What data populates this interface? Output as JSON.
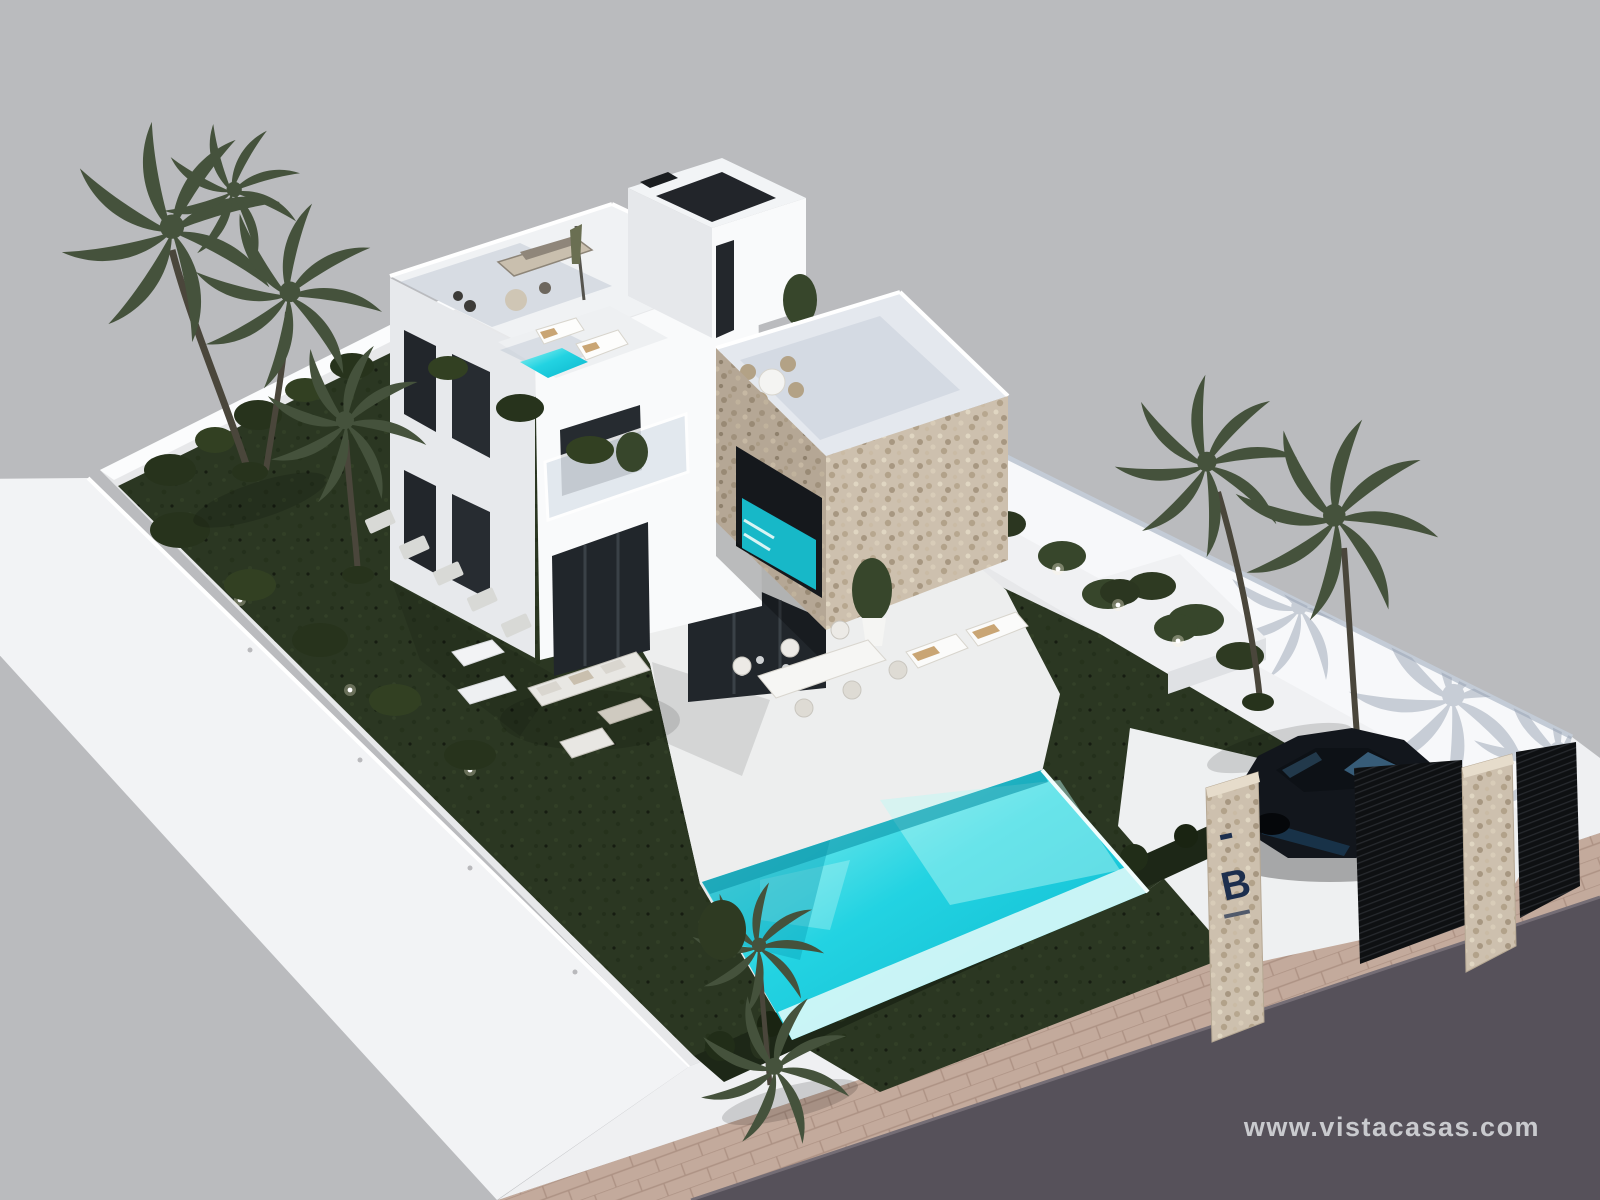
{
  "watermark": {
    "text": "www.vistacasas.com"
  },
  "gate": {
    "logo_letter": "B"
  },
  "colors": {
    "background": "#babbbe",
    "podium": "#f2f3f5",
    "street_wall": "#eff0f2",
    "interior": "#e7e8ea",
    "patio": "#edeeee",
    "lawn": "#2b3722",
    "hedge": "#1d2717",
    "pool_light": "#9ff4f1",
    "pool_mid": "#23d3e2",
    "pool_deep": "#0ab5cc",
    "stone_lit": "#cdc0ae",
    "stone_shade": "#b5a795",
    "road": "#56515a",
    "sidewalk": "#c3aa9c",
    "car_body": "#12161c",
    "palm": "#45523c",
    "plant": "#37462b",
    "watermark_text": "#d0d1d5",
    "passage_wall": "#f7f8fa",
    "house_white": "#f9fafb",
    "house_shade": "#e7e9ec",
    "glass_dark": "#21262b",
    "terrace_tile": "#b7c1cf",
    "driveway": "#eef0f1"
  }
}
